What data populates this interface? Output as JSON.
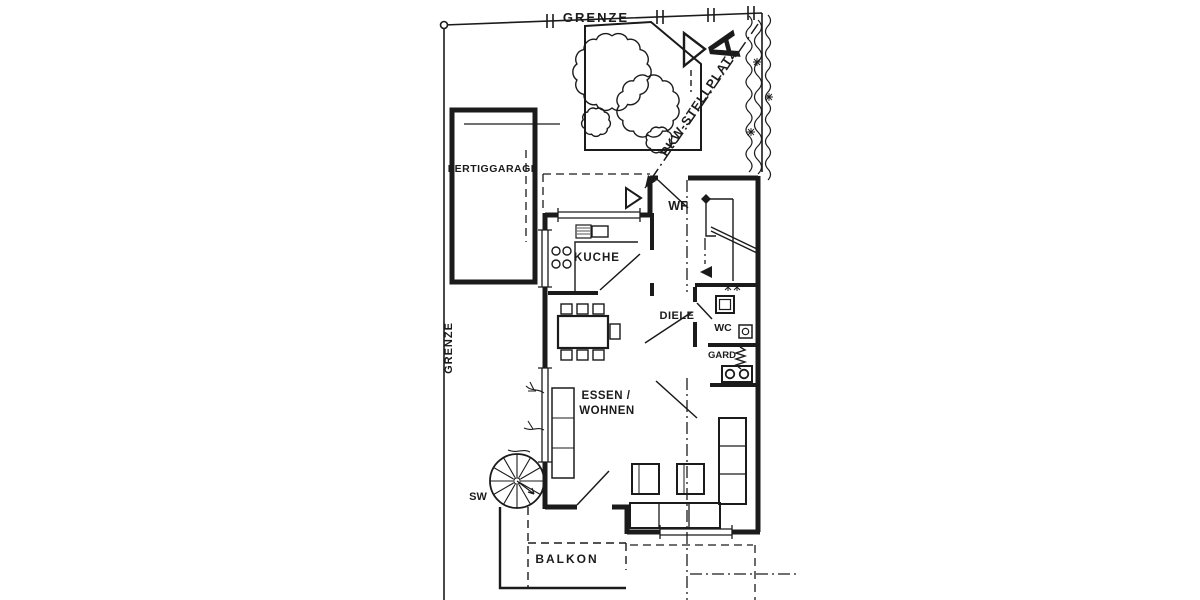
{
  "colors": {
    "ink": "#1b1b1b",
    "paper": "#ffffff"
  },
  "site": {
    "boundary_top": "GRENZE",
    "boundary_left": "GRENZE",
    "parking": "PKW-STELLPLATZ",
    "marker": "A"
  },
  "garage": {
    "label": "FERTIGGARAGE"
  },
  "rooms": {
    "kitchen": "KUCHE",
    "vestibule": "WF",
    "hall": "DIELE",
    "wc": "WC",
    "wardrobe": "GARD",
    "living_line1": "ESSEN /",
    "living_line2": "WOHNEN"
  },
  "outdoor": {
    "spiral_stair": "SW",
    "balcony": "BALKON"
  }
}
